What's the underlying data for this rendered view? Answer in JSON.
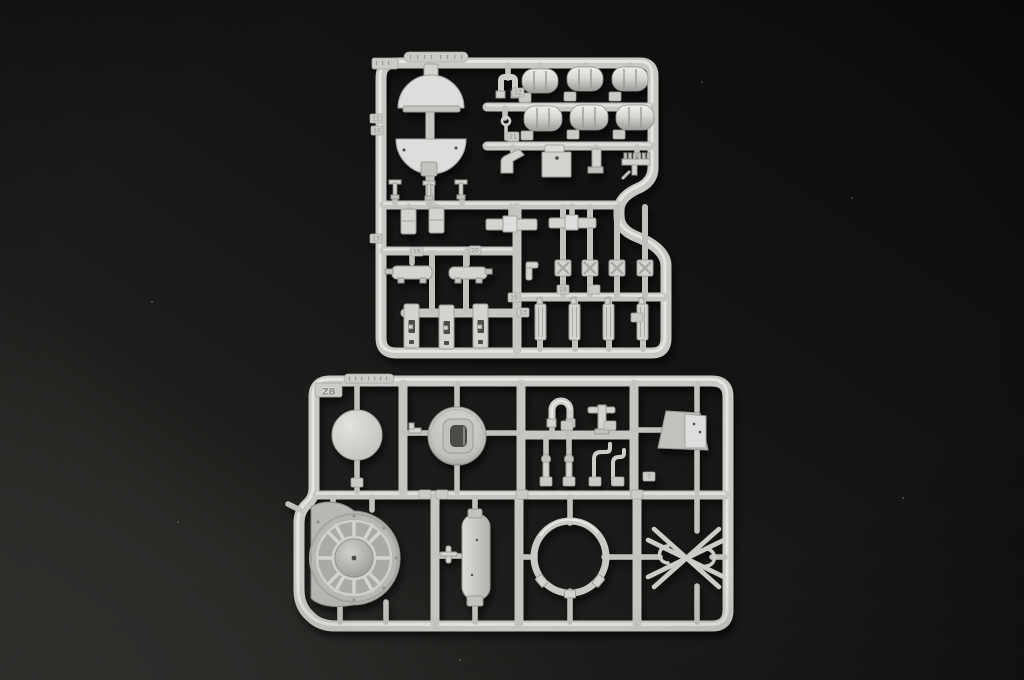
{
  "scene": {
    "type": "photograph",
    "subject": "Two light-grey injection-moulded plastic model-kit sprues (parts trees) lying on a dark charcoal background",
    "background": {
      "top_right_color": "#0d0c0b",
      "bottom_left_color": "#403f3c"
    },
    "plastic_color": "#cdccc9",
    "sprues": [
      {
        "name": "upper-sprue",
        "label": "",
        "marking": "illegible embossed mold stamp",
        "shape": "rounded rectangular frame with an S-shaped notch cut into the right edge",
        "parts": [
          "turret-roof half disc (upper)",
          "turret-roof half disc (lower)",
          "ribbed stowage drum x6",
          "U-staple bracket",
          "J-hook",
          "stowage box with lid",
          "angled channel bracket",
          "L-bracket",
          "toothed rack",
          "small lever x3",
          "hinge plate x2",
          "flanged axle bar x2",
          "exhaust muffler x2",
          "slotted link plate x3",
          "X-ribbed hatch x4",
          "elbow fitting",
          "ribbed tool body x4"
        ]
      },
      {
        "name": "lower-sprue",
        "label": "ZB",
        "marking": "illegible embossed mold stamp",
        "shape": "rounded rectangular frame",
        "parts": [
          "flat circular disc",
          "domed ring with D-shaped opening",
          "horseshoe clamp",
          "T-fitting",
          "flared cowl",
          "ball-head pin x2",
          "bent rod x2",
          "blower fan housing with radial ribs",
          "oval hatch plate",
          "small cross pin",
          "large ring with three lugs",
          "crossed-rod brace with clamp hooks"
        ]
      }
    ],
    "gate_tags": [
      "11",
      "10",
      "13",
      "12",
      "21",
      "16",
      "20",
      "18",
      "19",
      "13",
      "7"
    ]
  }
}
